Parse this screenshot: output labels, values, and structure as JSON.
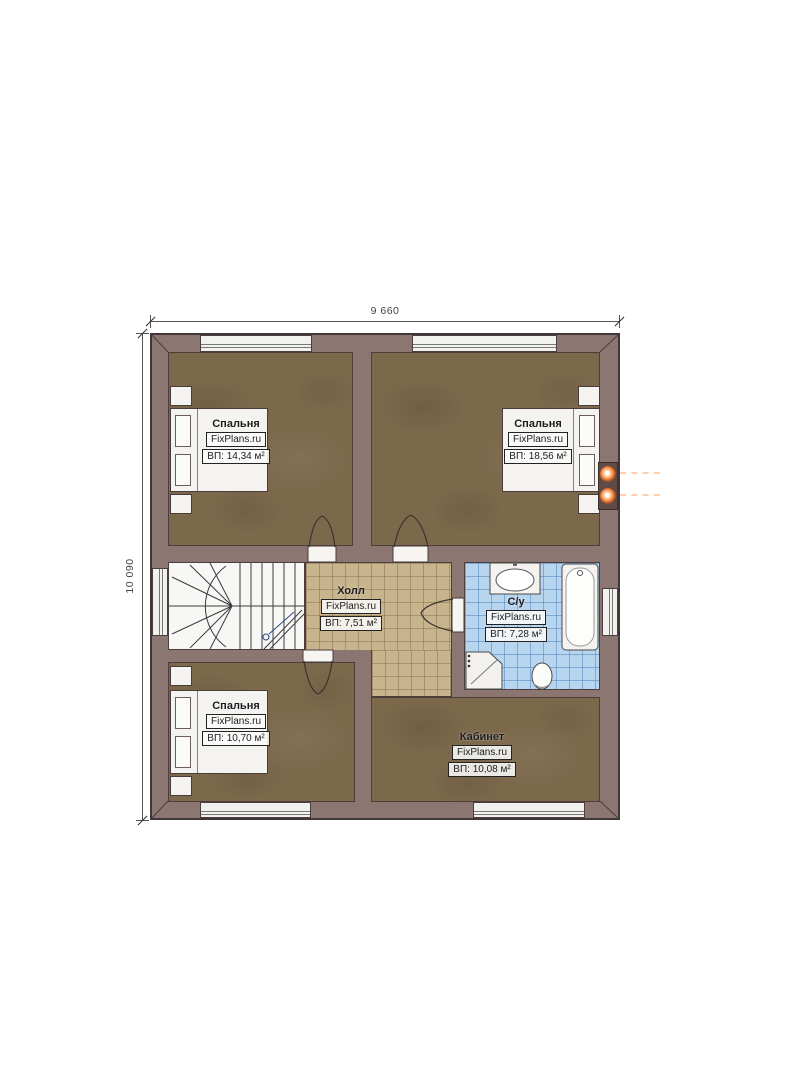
{
  "plan": {
    "title": "floor-plan",
    "dimensions": {
      "top": "9 660",
      "left": "10 090"
    },
    "rooms": [
      {
        "id": "bedroom-top-left",
        "name": "Спальня",
        "brand": "FixPlans.ru",
        "area": "ВП: 14,34 м²"
      },
      {
        "id": "bedroom-top-right",
        "name": "Спальня",
        "brand": "FixPlans.ru",
        "area": "ВП: 18,56 м²"
      },
      {
        "id": "hall",
        "name": "Холл",
        "brand": "FixPlans.ru",
        "area": "ВП: 7,51 м²"
      },
      {
        "id": "bathroom",
        "name": "С/у",
        "brand": "FixPlans.ru",
        "area": "ВП: 7,28 м²"
      },
      {
        "id": "bedroom-bottom-left",
        "name": "Спальня",
        "brand": "FixPlans.ru",
        "area": "ВП: 10,70 м²"
      },
      {
        "id": "office",
        "name": "Кабинет",
        "brand": "FixPlans.ru",
        "area": "ВП: 10,08 м²"
      }
    ],
    "colors": {
      "wall": "#8c7672",
      "wood_floor": "#7c684b",
      "hall_tile": "#c8b48d",
      "bath_tile": "#b8d5f0",
      "flue_glow": "#ff9a4d"
    }
  }
}
